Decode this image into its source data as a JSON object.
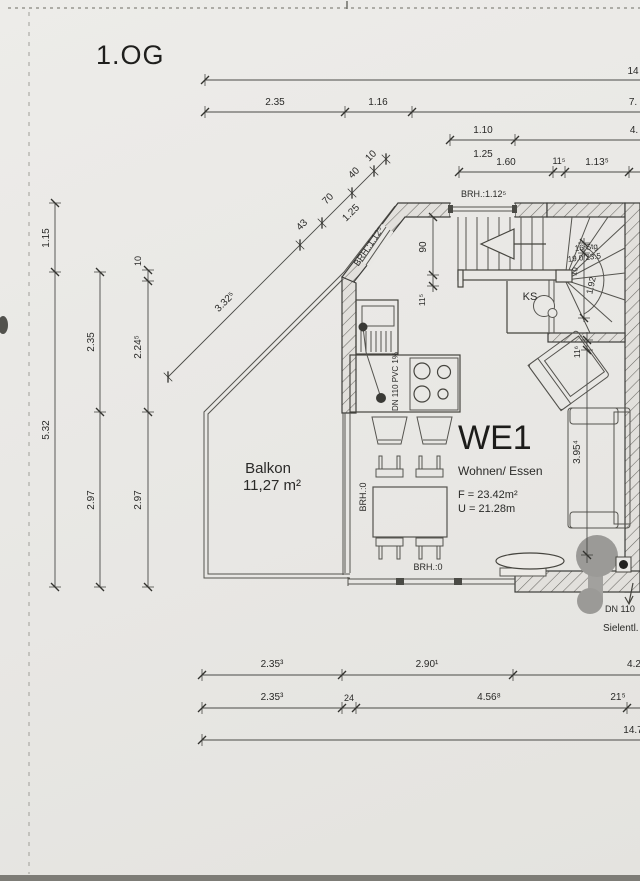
{
  "title": "1.OG",
  "plan": {
    "unit_label": "WE1",
    "room_label": "Wohnen/ Essen",
    "area_label": "F = 23.42m²",
    "perimeter_label": "U = 21.28m",
    "balcony_label": "Balkon",
    "balcony_area": "11,27 m²",
    "stairs_line1": "16 Stg",
    "stairs_line2": "19.0/23.5",
    "ks_label": "KS",
    "pipe_label": "DN 110 PVC 1%",
    "drain_label1": "DN 110",
    "drain_label2": "Sielentl."
  },
  "sill_labels": {
    "top_window": "BRH.:1.12⁵",
    "diagonal_window": "BRH.:1.12⁵",
    "left_window": "BRH.:0",
    "bottom_window": "BRH.:0"
  },
  "dimensions": {
    "top_total": "14",
    "top_row2": [
      "2.35",
      "1.16",
      "7."
    ],
    "top_row3": [
      "1.10",
      "4."
    ],
    "top_row3_alt": "1.25",
    "top_row4": [
      "1.60",
      "11⁵",
      "1.13⁵"
    ],
    "left_outer": [
      "1.15",
      "5.32"
    ],
    "left_mid": [
      "2.35",
      "2.97"
    ],
    "left_inner": [
      "10",
      "2.24⁵",
      "2.97"
    ],
    "diagonal": [
      "3.32⁵",
      "43",
      "70",
      "40",
      "10"
    ],
    "diagonal_alt": "1.25",
    "stair_opening": [
      "90",
      "11⁵"
    ],
    "stair_width": [
      "10",
      "1.92"
    ],
    "right_room": [
      "11⁶",
      "3.95⁴"
    ],
    "bottom_row1": [
      "2.35³",
      "2.90¹",
      "4.2"
    ],
    "bottom_row2": [
      "2.35³",
      "24",
      "4.56⁸",
      "21⁵"
    ],
    "bottom_total": "14.7"
  }
}
